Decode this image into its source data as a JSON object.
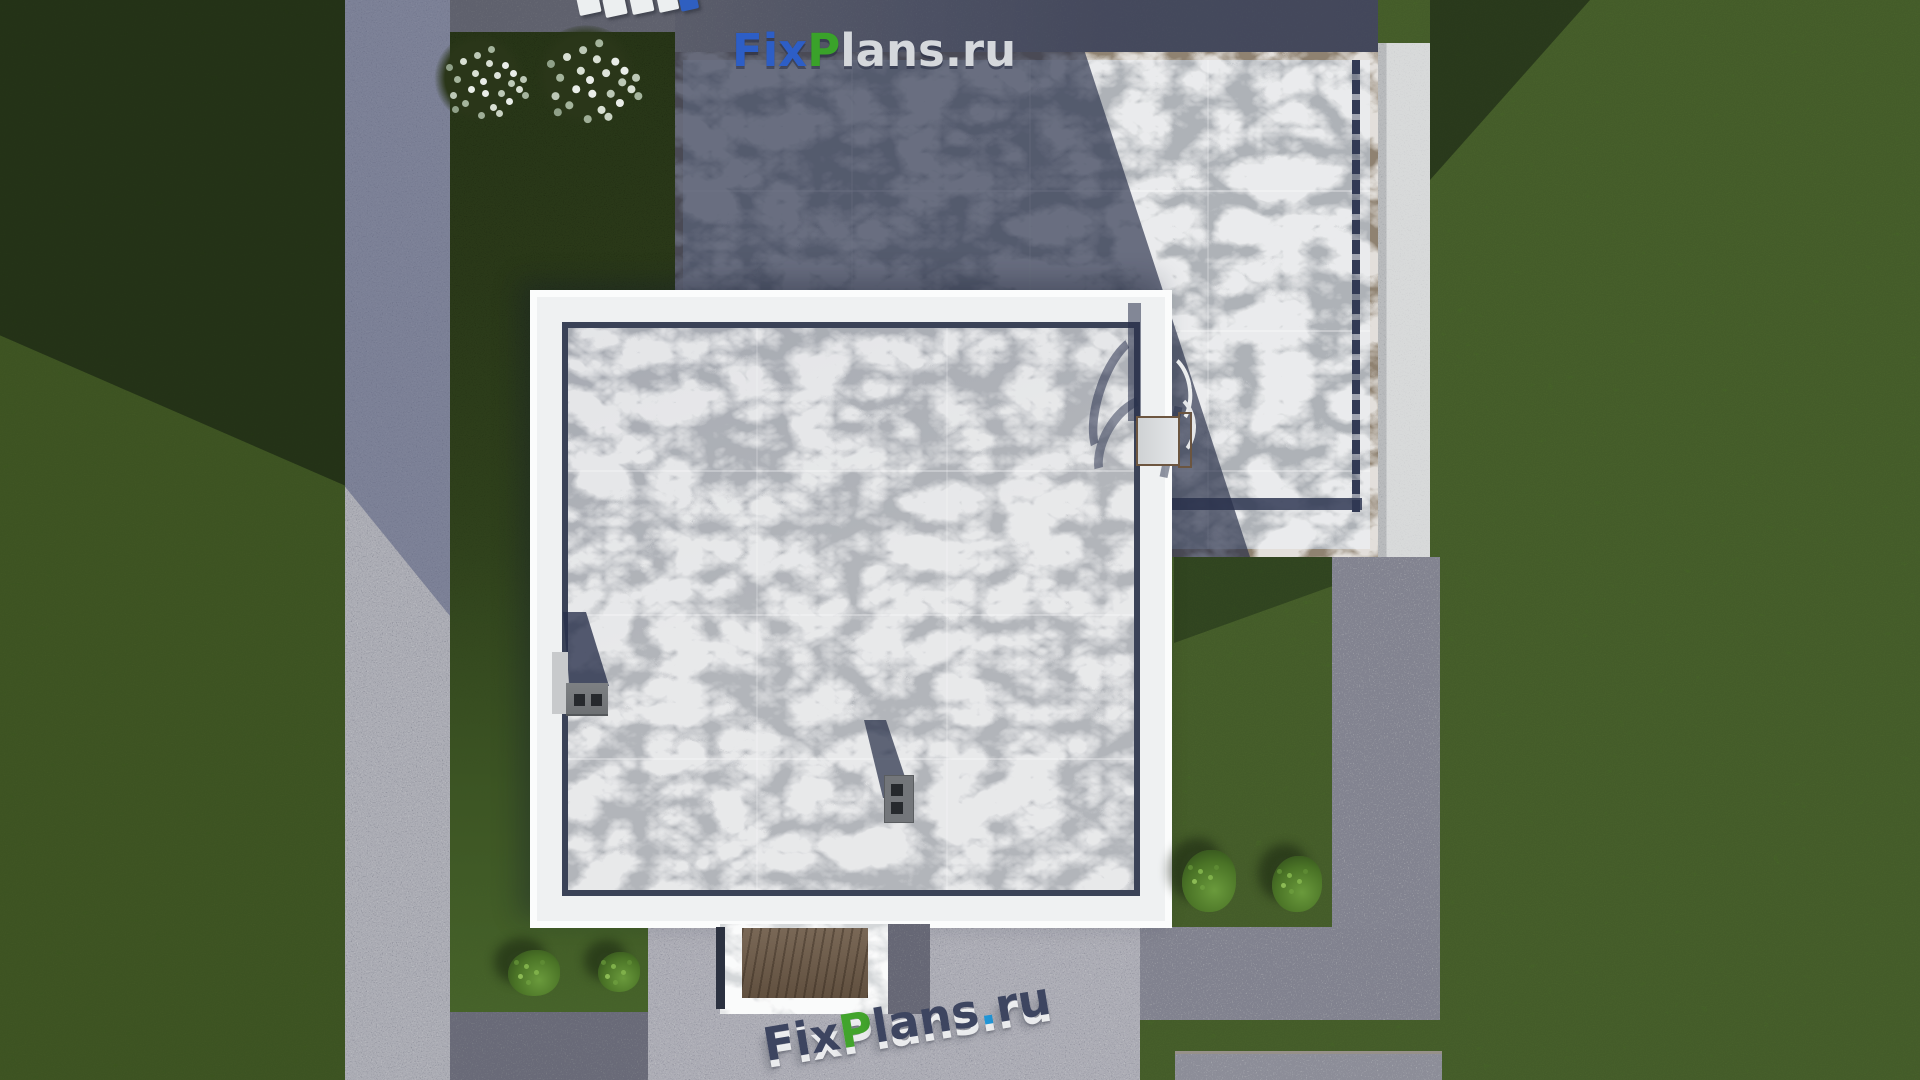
{
  "scene": {
    "description": "Aerial top-down 3D architectural render of a flat-roof house plot",
    "buildings": 2,
    "flowering_trees": 2,
    "shrubs": 4
  },
  "watermarks": {
    "top": {
      "text": "FixPlans.ru",
      "segments": [
        {
          "text": "Fix",
          "color": "#2d5ec6"
        },
        {
          "text": "P",
          "color": "#3aa22a"
        },
        {
          "text": "lans",
          "color": "#d5d8dc"
        },
        {
          "text": ".ru",
          "color": "#d5d8dc"
        }
      ]
    },
    "bottom": {
      "text": "FixPlans.ru",
      "segments": [
        {
          "text": "Fix",
          "color": "#3d4560"
        },
        {
          "text": "P",
          "color": "#42a42c"
        },
        {
          "text": "lans",
          "color": "#3d4560"
        },
        {
          "text": ".",
          "color": "#2095d6"
        },
        {
          "text": "ru",
          "color": "#3d4560"
        }
      ]
    },
    "top_edge_fragments": {
      "colors": [
        "#eceff0",
        "#eceff0",
        "#eceff0",
        "#eceff0",
        "#2f5fc0"
      ]
    }
  },
  "palette": {
    "grass": "#4b7026",
    "grass_shadow": "#2c4218",
    "dark_lawn": "#202b12",
    "concrete_light": "#b9bbbc",
    "concrete_dark": "#8c8f92",
    "asphalt_shadow": "#4a5160",
    "roof_lit": "#aeb2b7",
    "roof_shadow": "#4e566e",
    "roof_border_tan": "#8f8271",
    "navy_trim": "#3a4257",
    "parapet_white": "#f0f1f2",
    "terrace_wood": "#6e5b48",
    "terrace_marble": "#d4d7d9"
  }
}
